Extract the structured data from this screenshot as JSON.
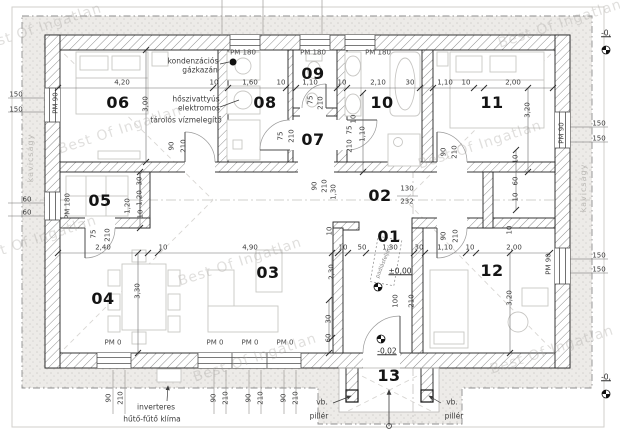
{
  "watermark": {
    "text": "Best Of Ingatlan"
  },
  "watermarks": [
    {
      "x": 40,
      "y": 28,
      "r": -18
    },
    {
      "x": 560,
      "y": 24,
      "r": -18
    },
    {
      "x": 120,
      "y": 130,
      "r": -18
    },
    {
      "x": 480,
      "y": 145,
      "r": -18
    },
    {
      "x": 240,
      "y": 262,
      "r": -18
    },
    {
      "x": 35,
      "y": 240,
      "r": -18
    },
    {
      "x": 255,
      "y": 358,
      "r": -18
    },
    {
      "x": 552,
      "y": 350,
      "r": -18
    }
  ],
  "rooms": [
    {
      "t": "06",
      "x": 118,
      "y": 103
    },
    {
      "t": "08",
      "x": 265,
      "y": 103
    },
    {
      "t": "09",
      "x": 313,
      "y": 74
    },
    {
      "t": "07",
      "x": 313,
      "y": 140
    },
    {
      "t": "10",
      "x": 382,
      "y": 103
    },
    {
      "t": "11",
      "x": 492,
      "y": 103
    },
    {
      "t": "05",
      "x": 100,
      "y": 201
    },
    {
      "t": "02",
      "x": 380,
      "y": 196
    },
    {
      "t": "01",
      "x": 389,
      "y": 237
    },
    {
      "t": "04",
      "x": 103,
      "y": 299
    },
    {
      "t": "03",
      "x": 268,
      "y": 273
    },
    {
      "t": "12",
      "x": 492,
      "y": 271
    },
    {
      "t": "13",
      "x": 389,
      "y": 376
    }
  ],
  "levels": [
    {
      "t": "±0,00",
      "x": 400,
      "y": 271
    },
    {
      "t": "-0,02",
      "x": 387,
      "y": 351
    },
    {
      "t": "-0,",
      "x": 606,
      "y": 33
    },
    {
      "t": "-0,",
      "x": 606,
      "y": 377
    }
  ],
  "labels": [
    {
      "t": "4,20",
      "x": 122,
      "y": 83
    },
    {
      "t": "10",
      "x": 214,
      "y": 83
    },
    {
      "t": "1,60",
      "x": 250,
      "y": 83
    },
    {
      "t": "10",
      "x": 281,
      "y": 83
    },
    {
      "t": "1,10",
      "x": 310,
      "y": 83
    },
    {
      "t": "10",
      "x": 342,
      "y": 83
    },
    {
      "t": "2,10",
      "x": 378,
      "y": 83
    },
    {
      "t": "30",
      "x": 410,
      "y": 83
    },
    {
      "t": "1,10",
      "x": 445,
      "y": 83
    },
    {
      "t": "10",
      "x": 466,
      "y": 83
    },
    {
      "t": "2,00",
      "x": 513,
      "y": 83
    },
    {
      "t": "2,40",
      "x": 103,
      "y": 248
    },
    {
      "t": "10",
      "x": 163,
      "y": 248
    },
    {
      "t": "4,90",
      "x": 250,
      "y": 248
    },
    {
      "t": "10",
      "x": 343,
      "y": 248
    },
    {
      "t": "50",
      "x": 362,
      "y": 248
    },
    {
      "t": "1,30",
      "x": 390,
      "y": 248
    },
    {
      "t": "30",
      "x": 419,
      "y": 248
    },
    {
      "t": "1,10",
      "x": 445,
      "y": 248
    },
    {
      "t": "10",
      "x": 470,
      "y": 248
    },
    {
      "t": "2,00",
      "x": 514,
      "y": 248
    },
    {
      "t": "3,00",
      "x": 146,
      "y": 104,
      "r": -90
    },
    {
      "t": "10",
      "x": 354,
      "y": 119,
      "r": -90
    },
    {
      "t": "1,10",
      "x": 363,
      "y": 134,
      "r": -90
    },
    {
      "t": "3,20",
      "x": 528,
      "y": 110,
      "r": -90
    },
    {
      "t": "3,30",
      "x": 138,
      "y": 291,
      "r": -90
    },
    {
      "t": "2,30",
      "x": 332,
      "y": 272,
      "r": -90
    },
    {
      "t": "3,20",
      "x": 510,
      "y": 298,
      "r": -90
    },
    {
      "t": "30",
      "x": 140,
      "y": 181,
      "r": -90
    },
    {
      "t": "1,20",
      "x": 140,
      "y": 198,
      "r": -90
    },
    {
      "t": "10",
      "x": 141,
      "y": 214,
      "r": -90
    },
    {
      "t": "1,20",
      "x": 128,
      "y": 206,
      "r": -90
    },
    {
      "t": "10",
      "x": 330,
      "y": 231,
      "r": -90
    },
    {
      "t": "10",
      "x": 510,
      "y": 230,
      "r": -90
    },
    {
      "t": "30",
      "x": 329,
      "y": 319,
      "r": -90
    },
    {
      "t": "60",
      "x": 329,
      "y": 338,
      "r": -90
    },
    {
      "t": "10",
      "x": 516,
      "y": 159,
      "r": -90
    },
    {
      "t": "60",
      "x": 516,
      "y": 181,
      "r": -90
    },
    {
      "t": "10",
      "x": 516,
      "y": 197,
      "r": -90
    },
    {
      "t": "1,30",
      "x": 334,
      "y": 192,
      "r": -90
    },
    {
      "t": "90",
      "x": 315,
      "y": 186,
      "r": -90
    },
    {
      "t": "210",
      "x": 325,
      "y": 186,
      "r": -90
    },
    {
      "t": "90",
      "x": 172,
      "y": 146,
      "r": -90
    },
    {
      "t": "210",
      "x": 184,
      "y": 146,
      "r": -90
    },
    {
      "t": "75",
      "x": 281,
      "y": 136,
      "r": -90
    },
    {
      "t": "210",
      "x": 292,
      "y": 136,
      "r": -90
    },
    {
      "t": "75",
      "x": 311,
      "y": 100,
      "r": -90
    },
    {
      "t": "210",
      "x": 321,
      "y": 103,
      "r": -90
    },
    {
      "t": "75",
      "x": 350,
      "y": 130,
      "r": -90
    },
    {
      "t": "210",
      "x": 350,
      "y": 146,
      "r": -90
    },
    {
      "t": "75",
      "x": 94,
      "y": 234,
      "r": -90
    },
    {
      "t": "210",
      "x": 108,
      "y": 235,
      "r": -90
    },
    {
      "t": "100",
      "x": 396,
      "y": 301,
      "r": -90
    },
    {
      "t": "210",
      "x": 412,
      "y": 301,
      "r": -90
    },
    {
      "t": "90",
      "x": 444,
      "y": 152,
      "r": -90
    },
    {
      "t": "210",
      "x": 455,
      "y": 152,
      "r": -90
    },
    {
      "t": "90",
      "x": 444,
      "y": 236,
      "r": -90
    },
    {
      "t": "210",
      "x": 456,
      "y": 236,
      "r": -90
    },
    {
      "t": "90",
      "x": 109,
      "y": 398,
      "r": -90
    },
    {
      "t": "210",
      "x": 121,
      "y": 398,
      "r": -90
    },
    {
      "t": "90",
      "x": 214,
      "y": 398,
      "r": -90
    },
    {
      "t": "210",
      "x": 226,
      "y": 398,
      "r": -90
    },
    {
      "t": "90",
      "x": 249,
      "y": 398,
      "r": -90
    },
    {
      "t": "210",
      "x": 261,
      "y": 398,
      "r": -90
    },
    {
      "t": "90",
      "x": 284,
      "y": 398,
      "r": -90
    },
    {
      "t": "210",
      "x": 296,
      "y": 398,
      "r": -90
    },
    {
      "t": "150",
      "x": 16,
      "y": 95
    },
    {
      "t": "150",
      "x": 16,
      "y": 110
    },
    {
      "t": "60",
      "x": 27,
      "y": 200
    },
    {
      "t": "60",
      "x": 27,
      "y": 213
    },
    {
      "t": "150",
      "x": 599,
      "y": 124
    },
    {
      "t": "150",
      "x": 599,
      "y": 139
    },
    {
      "t": "150",
      "x": 599,
      "y": 256
    },
    {
      "t": "150",
      "x": 599,
      "y": 270
    },
    {
      "t": "130",
      "x": 407,
      "y": 189
    },
    {
      "t": "232",
      "x": 407,
      "y": 202
    },
    {
      "t": "PM 180",
      "x": 243,
      "y": 53,
      "c": "pm"
    },
    {
      "t": "PM 180",
      "x": 313,
      "y": 53,
      "c": "pm"
    },
    {
      "t": "PM 180",
      "x": 378,
      "y": 53,
      "c": "pm"
    },
    {
      "t": "PM 90",
      "x": 56,
      "y": 103,
      "r": -90,
      "c": "pm"
    },
    {
      "t": "PM 180",
      "x": 68,
      "y": 206,
      "r": -90,
      "c": "pm"
    },
    {
      "t": "PM 90",
      "x": 562,
      "y": 133,
      "r": -90,
      "c": "pm"
    },
    {
      "t": "PM 90",
      "x": 549,
      "y": 264,
      "r": -90,
      "c": "pm"
    },
    {
      "t": "PM 0",
      "x": 113,
      "y": 343,
      "c": "pm"
    },
    {
      "t": "PM 0",
      "x": 215,
      "y": 343,
      "c": "pm"
    },
    {
      "t": "PM 0",
      "x": 250,
      "y": 343,
      "c": "pm"
    },
    {
      "t": "PM 0",
      "x": 285,
      "y": 343,
      "c": "pm"
    },
    {
      "t": "kondenzációs",
      "x": 193,
      "y": 61,
      "c": "note"
    },
    {
      "t": "gázkazán",
      "x": 200,
      "y": 70,
      "c": "note"
    },
    {
      "t": "hőszivattyús",
      "x": 196,
      "y": 99,
      "c": "note"
    },
    {
      "t": "elektromos",
      "x": 199,
      "y": 108,
      "c": "note"
    },
    {
      "t": "tárolós vízmelegítő",
      "x": 186,
      "y": 120,
      "c": "note"
    },
    {
      "t": "inverteres",
      "x": 156,
      "y": 407,
      "c": "note"
    },
    {
      "t": "hűtő-fűtő klíma",
      "x": 152,
      "y": 419,
      "c": "note"
    },
    {
      "t": "vb.",
      "x": 322,
      "y": 402,
      "c": "note"
    },
    {
      "t": "pillér",
      "x": 319,
      "y": 416,
      "c": "note"
    },
    {
      "t": "vb.",
      "x": 452,
      "y": 402,
      "c": "note"
    },
    {
      "t": "pillér",
      "x": 454,
      "y": 416,
      "c": "note"
    },
    {
      "t": "kavicságy",
      "x": 31,
      "y": 158,
      "r": -90,
      "c": "note-light"
    },
    {
      "t": "kavicságy",
      "x": 584,
      "y": 188,
      "r": -90,
      "c": "note-light"
    },
    {
      "t": "padlásfeljáró",
      "x": 385,
      "y": 262,
      "r": -68,
      "c": "note-tiny"
    }
  ]
}
